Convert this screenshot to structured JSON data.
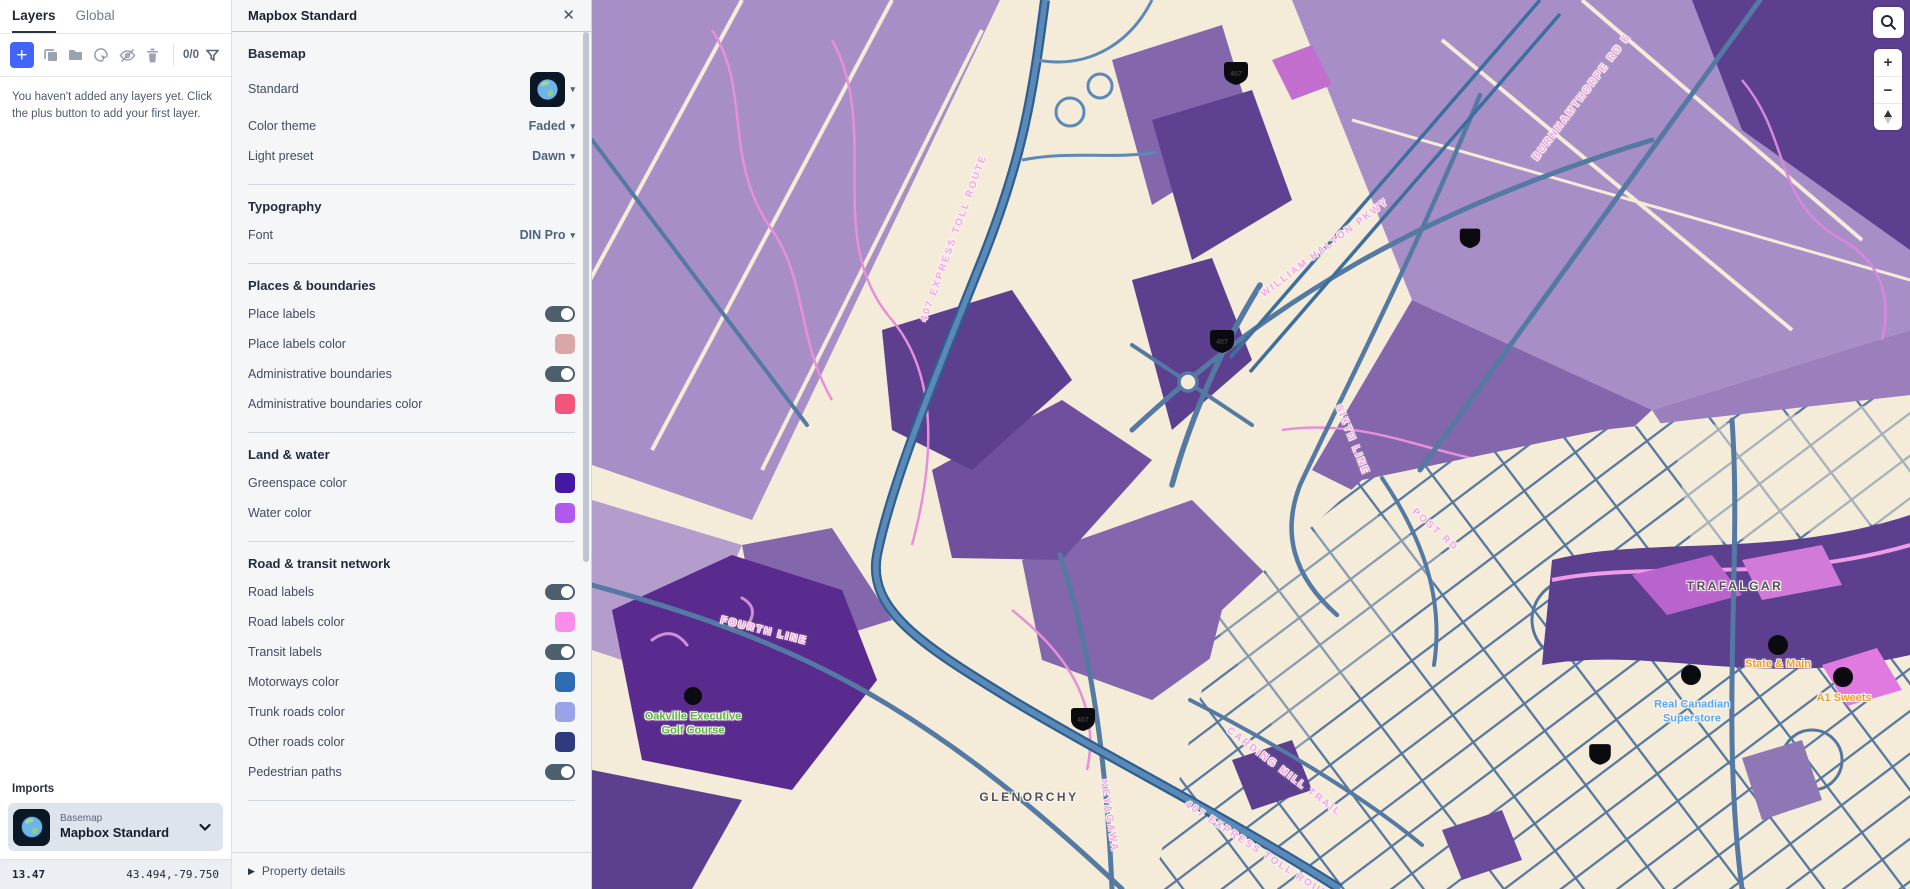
{
  "sidebar": {
    "tabs": [
      {
        "label": "Layers",
        "active": true
      },
      {
        "label": "Global",
        "active": false
      }
    ],
    "toolbar": {
      "counter": "0/0"
    },
    "empty_message": "You haven't added any layers yet. Click the plus button to add your first layer.",
    "imports": {
      "header": "Imports",
      "item": {
        "type_label": "Basemap",
        "name": "Mapbox Standard"
      }
    },
    "status_bar": {
      "zoom": "13.47",
      "coordinates": "43.494,-79.750"
    }
  },
  "panel": {
    "title": "Mapbox Standard",
    "basemap": {
      "header": "Basemap",
      "standard_label": "Standard",
      "color_theme_label": "Color theme",
      "color_theme_value": "Faded",
      "light_preset_label": "Light preset",
      "light_preset_value": "Dawn"
    },
    "typography": {
      "header": "Typography",
      "font_label": "Font",
      "font_value": "DIN Pro"
    },
    "places": {
      "header": "Places & boundaries",
      "place_labels_label": "Place labels",
      "place_labels_on": true,
      "place_labels_color_label": "Place labels color",
      "place_labels_color": "#d9a8a6",
      "admin_boundaries_label": "Administrative boundaries",
      "admin_boundaries_on": true,
      "admin_boundaries_color_label": "Administrative boundaries color",
      "admin_boundaries_color": "#f2547a"
    },
    "land_water": {
      "header": "Land & water",
      "greenspace_label": "Greenspace color",
      "greenspace_color": "#4517a5",
      "water_label": "Water color",
      "water_color": "#b159ec"
    },
    "roads": {
      "header": "Road & transit network",
      "road_labels_label": "Road labels",
      "road_labels_on": true,
      "road_labels_color_label": "Road labels color",
      "road_labels_color": "#f98de9",
      "transit_labels_label": "Transit labels",
      "transit_labels_on": true,
      "motorways_label": "Motorways color",
      "motorways_color": "#2e6cb3",
      "trunk_label": "Trunk roads color",
      "trunk_color": "#9aa3e8",
      "other_label": "Other roads color",
      "other_color": "#2e3b7d",
      "pedestrian_label": "Pedestrian paths",
      "pedestrian_on": true
    },
    "footer_label": "Property details"
  },
  "icons": {
    "plus": "+",
    "caret_down": "▾",
    "triangle_right": "▶",
    "close": "✕"
  },
  "map": {
    "controls": {
      "zoom_in": "+",
      "zoom_out": "−"
    },
    "colors": {
      "land": "#f4ebd9",
      "fields_light": "#a78ec6",
      "fields_medium": "#8466ad",
      "fields_dark": "#5d3f90",
      "greenspace": "#5a2b8e",
      "river": "#e78fd9",
      "motorway": "#5b8ab8",
      "street": "#54779f",
      "road_label": "#f9a2ec",
      "place_label": "#50505e",
      "poi_green": "#57b54a",
      "poi_blue": "#58a8f2",
      "poi_orange": "#f0a030"
    },
    "labels": [
      {
        "kind": "road",
        "text": "407 EXPRESS TOLL ROUTE",
        "x": 362,
        "y": 238,
        "rotate": -70,
        "color": "#f9a2ec"
      },
      {
        "kind": "road",
        "text": "407 EXPRESS TOLL ROUTE",
        "x": 668,
        "y": 852,
        "rotate": 33,
        "color": "#f9a2ec"
      },
      {
        "kind": "road",
        "text": "WILLIAM HALTON PKWY",
        "x": 733,
        "y": 248,
        "rotate": -37,
        "color": "#f9a2ec"
      },
      {
        "kind": "road",
        "text": "BURNHAMTHORPE RD E",
        "x": 990,
        "y": 97,
        "rotate": -53,
        "color": "#f9a2ec"
      },
      {
        "kind": "road",
        "text": "SIXTH LINE",
        "x": 760,
        "y": 440,
        "rotate": 68,
        "color": "#f9a2ec"
      },
      {
        "kind": "road",
        "text": "FOURTH LINE",
        "x": 172,
        "y": 631,
        "rotate": 14,
        "color": "#f9a2ec"
      },
      {
        "kind": "road",
        "text": "NEYAGAWA",
        "x": 517,
        "y": 816,
        "rotate": 81,
        "color": "#f9a2ec"
      },
      {
        "kind": "road",
        "text": "CARDING MILL TRAIL",
        "x": 692,
        "y": 772,
        "rotate": 37,
        "color": "#f9a2ec"
      },
      {
        "kind": "road",
        "text": "POST RD",
        "x": 843,
        "y": 530,
        "rotate": 42,
        "color": "#f9a2ec"
      },
      {
        "kind": "place",
        "text": "GLENORCHY",
        "x": 437,
        "y": 797,
        "color": "#50505e"
      },
      {
        "kind": "place",
        "text": "TRAFALGAR",
        "x": 1143,
        "y": 586,
        "color": "#50505e"
      },
      {
        "kind": "poi",
        "text": "Oakville Executive\nGolf Course",
        "x": 101,
        "y": 724,
        "color": "#57b54a"
      },
      {
        "kind": "poi",
        "text": "Real Canadian\nSuperstore",
        "x": 1100,
        "y": 712,
        "color": "#58a8f2"
      },
      {
        "kind": "poi",
        "text": "State & Main",
        "x": 1186,
        "y": 664,
        "color": "#f0a030"
      },
      {
        "kind": "poi",
        "text": "A1 Sweets",
        "x": 1252,
        "y": 698,
        "color": "#f0a030"
      }
    ]
  }
}
